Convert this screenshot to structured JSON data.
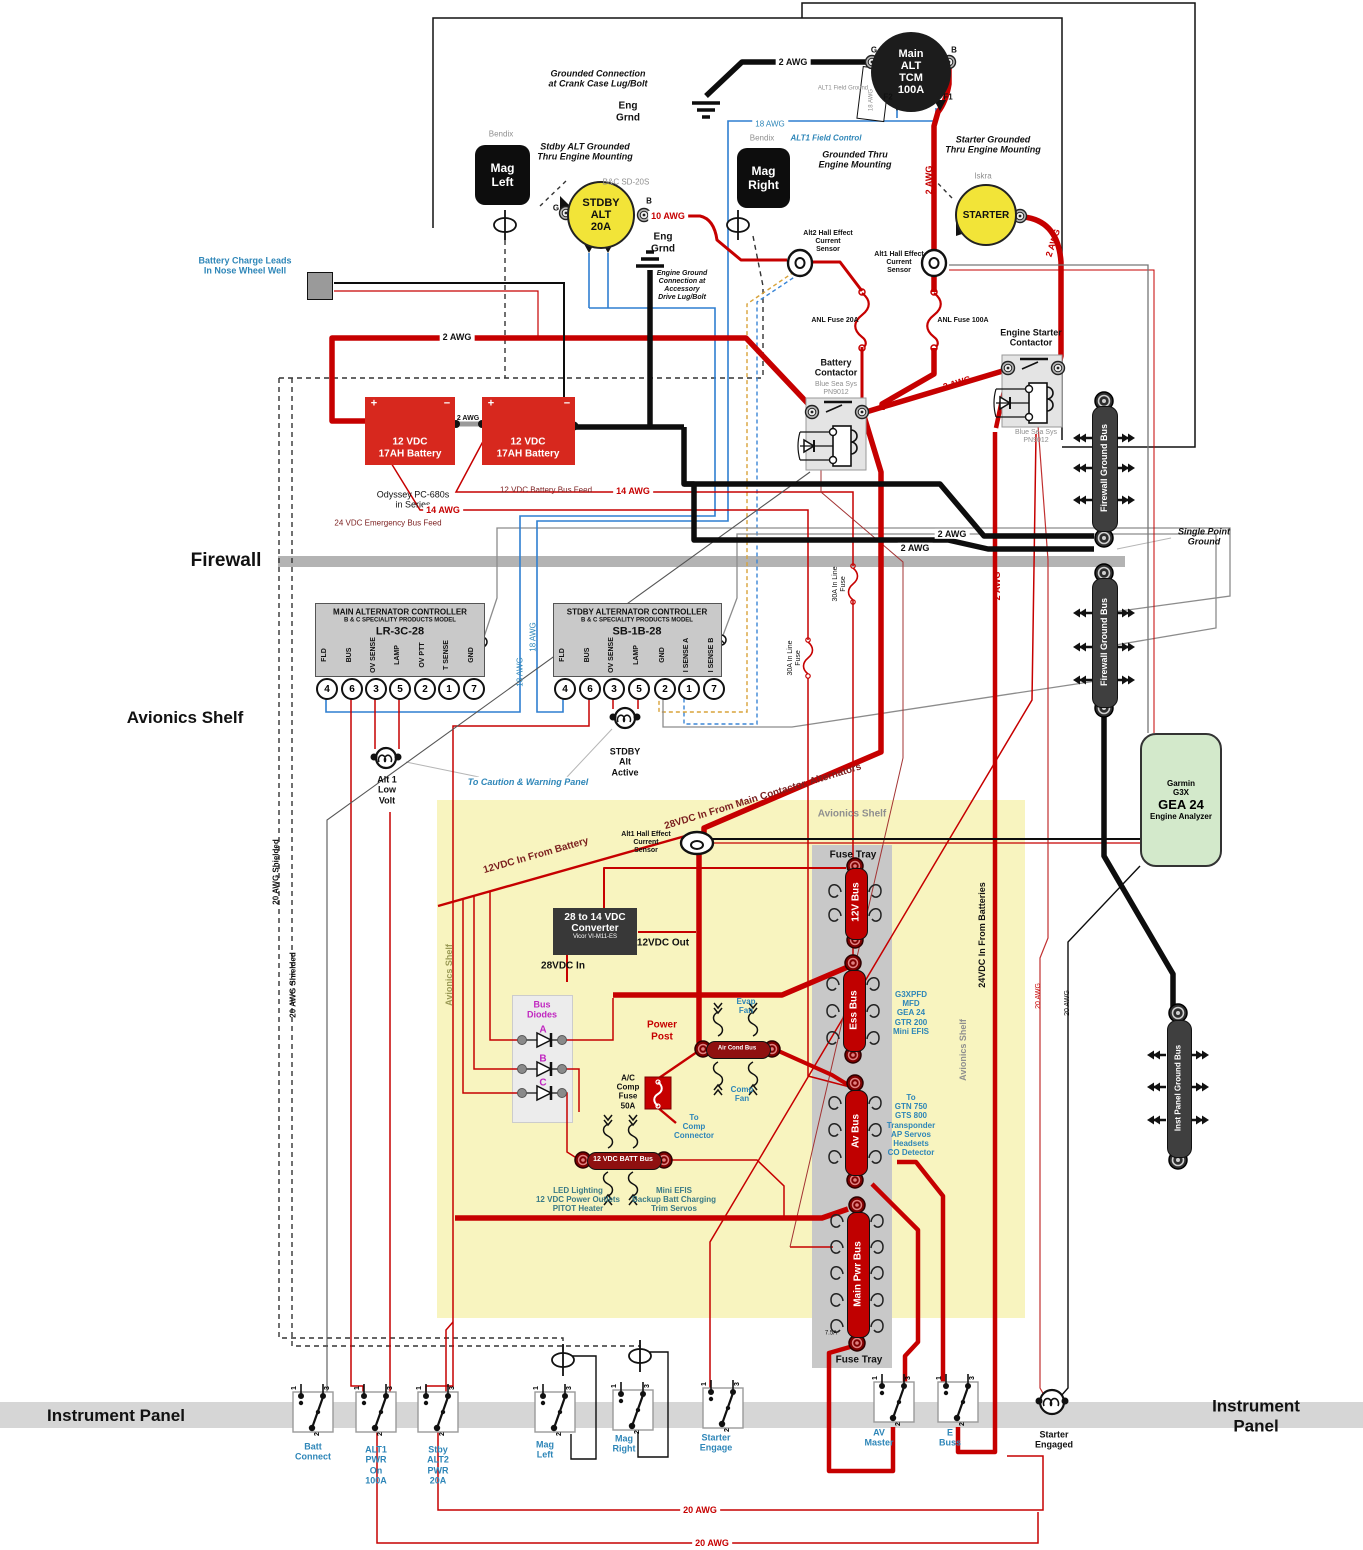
{
  "engine_bay": {
    "grounded_connection_note": "Grounded Connection\nat Crank Case Lug/Bolt",
    "eng_grnd_1": "Eng\nGrnd",
    "eng_grnd_2": "Eng\nGrnd",
    "engine_ground_note": "Engine Ground\nConnection at\nAccessory\nDrive Lug/Bolt",
    "main_alt": {
      "label": "Main\nALT\nTCM\n100A",
      "g": "G",
      "b": "B",
      "f1": "F1",
      "f2": "F2",
      "field_ground": "ALT1 Field Ground",
      "field_awg": "18 AWG"
    },
    "mag_left": {
      "brand": "Bendix",
      "label": "Mag\nLeft"
    },
    "mag_right": {
      "brand": "Bendix",
      "label": "Mag\nRight",
      "grounded_note": "Grounded Thru\nEngine Mounting"
    },
    "stdby_alt": {
      "brand": "B&C SD-20S",
      "label": "STDBY\nALT\n20A",
      "g": "G",
      "b": "B",
      "grounded_note": "Stdby ALT Grounded\nThru Engine Mounting"
    },
    "starter": {
      "brand": "Iskra",
      "label": "STARTER",
      "grounded_note": "Starter Grounded\nThru Engine Mounting"
    },
    "alt1_field_control": "ALT1 Field Control",
    "alt2_hall": "Alt2 Hall Effect\nCurrent\nSensor",
    "alt1_hall": "Alt1 Hall Effect\nCurrent\nSensor",
    "anl_fuse_20": "ANL Fuse 20A",
    "anl_fuse_100": "ANL Fuse 100A",
    "battery_contactor": {
      "label": "Battery\nContactor",
      "brand": "Blue Sea Sys\nPN9012"
    },
    "starter_contactor": {
      "label": "Engine Starter\nContactor",
      "brand": "Blue Sea Sys\nPN9012"
    }
  },
  "batteries": {
    "charge_leads": "Battery Charge Leads\nIn Nose Wheel Well",
    "battery_label": "12 VDC\n17AH Battery",
    "plus": "+",
    "minus": "−",
    "note": "Odyssey PC-680s\nin Series",
    "feed_12": "12 VDC Battery Bus Feed",
    "feed_24": "24 VDC Emergency Bus Feed"
  },
  "awg": {
    "crank": "2 AWG",
    "alt_b": "2 AWG",
    "starter": "2 AWG",
    "batt": "2 AWG",
    "batt_link": "2 AWG",
    "contactor": "2 AWG",
    "fw1": "2 AWG",
    "fw2": "2 AWG",
    "vert": "2 AWG",
    "stdby_b": "10 AWG",
    "field": "18 AWG",
    "field_v1": "18 AWG",
    "field_v2": "18 AWG",
    "feed14a": "14 AWG",
    "feed14b": "14 AWG",
    "shielded1": "20 AWG Shielded",
    "shielded2": "20 AWG Shielded",
    "v20_1": "20 AWG",
    "v20_2": "20 AWG",
    "b20_1": "20 AWG",
    "b20_2": "20 AWG",
    "fuse30a": "30A In Line\nFuse",
    "fuse30b": "30A In Line\nFuse"
  },
  "firewall": {
    "label": "Firewall",
    "single_point": "Single Point\nGround",
    "fw_bus_upper": "Firewall Ground Bus",
    "fw_bus_lower": "Firewall Ground Bus",
    "inst_bus": "Inst Panel Ground Bus"
  },
  "controllers": {
    "main": {
      "title": "MAIN ALTERNATOR CONTROLLER",
      "subtitle": "B & C SPECIALITY PRODUCTS MODEL",
      "model": "LR-3C-28",
      "terminals": [
        {
          "name": "FLD",
          "num": "4"
        },
        {
          "name": "BUS",
          "num": "6"
        },
        {
          "name": "OV SENSE",
          "num": "3"
        },
        {
          "name": "LAMP",
          "num": "5"
        },
        {
          "name": "OV PTT",
          "num": "2"
        },
        {
          "name": "T SENSE",
          "num": "1"
        },
        {
          "name": "GND",
          "num": "7"
        }
      ]
    },
    "stdby": {
      "title": "STDBY ALTERNATOR CONTROLLER",
      "subtitle": "B & C SPECIALITY PRODUCTS MODEL",
      "model": "SB-1B-28",
      "terminals": [
        {
          "name": "FLD",
          "num": "4"
        },
        {
          "name": "BUS",
          "num": "6"
        },
        {
          "name": "OV SENSE",
          "num": "3"
        },
        {
          "name": "LAMP",
          "num": "5"
        },
        {
          "name": "GND",
          "num": "2"
        },
        {
          "name": "I SENSE A",
          "num": "1"
        },
        {
          "name": "I SENSE B",
          "num": "7"
        }
      ]
    },
    "alt1_low_volt": "Alt 1\nLow\nVolt",
    "stdby_active": "STDBY\nAlt\nActive",
    "caution": "To Caution & Warning Panel"
  },
  "avionics": {
    "shelf_label_left": "Avionics Shelf",
    "shelf_label_top": "Avionics Shelf",
    "shelf_vert_left": "Avionics Shelf",
    "shelf_vert_right": "Avionics Shelf",
    "in28": "28VDC In From Main Contactor, Alternators",
    "in12": "12VDC In From Battery",
    "in24": "24VDC In From Batteries",
    "alt1_hall": "Alt1 Hall Effect\nCurrent\nSensor",
    "fuse_tray_top": "Fuse Tray",
    "fuse_tray_bottom": "Fuse Tray",
    "buses": [
      {
        "label": "12V Bus"
      },
      {
        "label": "Ess Bus"
      },
      {
        "label": "Av Bus"
      },
      {
        "label": "Main Pwr Bus"
      }
    ],
    "fuse_rating": "7.5A",
    "converter": {
      "line1": "28 to 14 VDC",
      "line2": "Converter",
      "line3": "Vicor VI-M11-ES",
      "out": "12VDC Out",
      "in": "28VDC In"
    },
    "bus_diodes": {
      "title": "Bus\nDiodes",
      "a": "A",
      "b": "B",
      "c": "C"
    },
    "power_post": "Power\nPost",
    "air_cond_bus": "Air Cond Bus",
    "evap_fan": "Evap\nFan",
    "comp_fan": "Comp\nFan",
    "ac_fuse": "A/C\nComp\nFuse\n50A",
    "to_comp": "To\nComp\nConnector",
    "batt_bus": "12 VDC BATT Bus",
    "batt_bus_left_loads": "LED Lighting\n12 VDC Power Outlets\nPITOT Heater",
    "batt_bus_right_loads": "Mini EFIS\nBackup Batt Charging\nTrim Servos",
    "ess_loads": "G3XPFD\nMFD\nGEA 24\nGTR 200\nMini EFIS",
    "av_loads": "To\nGTN 750\nGTS 800\nTransponder\nAP Servos\nHeadsets\nCO Detector",
    "gea24": {
      "line1": "Garmin",
      "line2": "G3X",
      "line3": "GEA 24",
      "line4": "Engine Analyzer"
    }
  },
  "panel": {
    "left": "Instrument Panel",
    "right": "Instrument Panel",
    "switches": [
      {
        "label": "Batt\nConnect"
      },
      {
        "label": "ALT1\nPWR\nOn\n100A"
      },
      {
        "label": "Stby\nALT2\nPWR\n20A"
      },
      {
        "label": "Mag\nLeft"
      },
      {
        "label": "Mag\nRight"
      },
      {
        "label": "Starter\nEngage"
      },
      {
        "label": "AV\nMaster"
      },
      {
        "label": "E\nBuss"
      }
    ],
    "terminal_nums": [
      "1",
      "3",
      "2"
    ],
    "starter_engaged": "Starter\nEngaged"
  },
  "colors": {
    "power_red": "#c60000",
    "ground_black": "#0d0d0d",
    "field_blue": "#2f7fd0",
    "bus_red": "#c00000",
    "highlight_yellow": "#f8f4bf",
    "gea_green": "#d3e9cb",
    "label_blue": "#2e86b8"
  }
}
